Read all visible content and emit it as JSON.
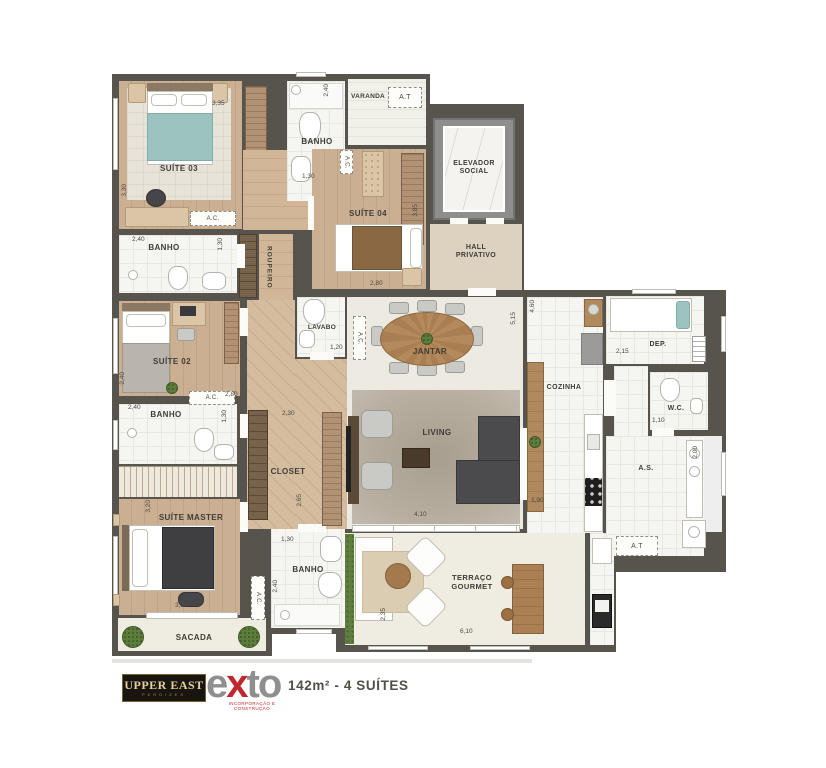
{
  "plan": {
    "shared": {
      "ac": "A.C.",
      "at": "A.T"
    },
    "rooms": {
      "suite03": {
        "label": "SUÍTE 03",
        "dim_w": "3,35",
        "dim_h": "3,30"
      },
      "banho04": {
        "label": "BANHO",
        "dim_h": "2,40",
        "dim_w": "1,30"
      },
      "varanda": {
        "label": "VARANDA"
      },
      "suite04": {
        "label": "SUÍTE 04",
        "dim_w": "2,80",
        "dim_h": "3,85"
      },
      "elevador": {
        "line1": "ELEVADOR",
        "line2": "SOCIAL"
      },
      "hall": {
        "line1": "HALL",
        "line2": "PRIVATIVO"
      },
      "roupeiro": {
        "label": "ROUPEIRO"
      },
      "banho03": {
        "label": "BANHO",
        "dim_w": "2,40",
        "dim_h": "1,30"
      },
      "suite02": {
        "label": "SUÍTE 02",
        "dim_w": "2,80",
        "dim_h": "2,40"
      },
      "banho02": {
        "label": "BANHO",
        "dim_w": "2,40",
        "dim_h": "1,30"
      },
      "lavabo": {
        "label": "LAVABO",
        "dim_w": "1,20"
      },
      "jantar": {
        "label": "JANTAR",
        "dim_h": "5,15"
      },
      "cozinha": {
        "label": "COZINHA",
        "dim_h": "4,60",
        "dim_w": "1,90"
      },
      "dep": {
        "label": "DEP.",
        "dim_w": "2,15"
      },
      "wc": {
        "label": "W.C.",
        "dim_w": "1,10"
      },
      "as": {
        "label": "A.S.",
        "dim_h": "2,00"
      },
      "corredor": {
        "dim_w": "2,30"
      },
      "closet": {
        "label": "CLOSET",
        "dim_h": "2,65"
      },
      "master": {
        "label": "SUÍTE MASTER",
        "dim_h": "3,20",
        "dim_w": "3,30"
      },
      "banhoMaster": {
        "label": "BANHO",
        "dim_w": "1,30",
        "dim_h": "2,40"
      },
      "sacada": {
        "label": "SACADA"
      },
      "living": {
        "label": "LIVING",
        "dim_w": "4,10"
      },
      "terraco": {
        "line1": "TERRAÇO",
        "line2": "GOURMET",
        "dim_w": "6,10",
        "dim_h": "2,35"
      }
    }
  },
  "footer": {
    "brand_primary": "UPPER EAST",
    "brand_primary_sub": "PERDIZES",
    "brand_secondary_part1": "e",
    "brand_secondary_part2": "x",
    "brand_secondary_part3": "to",
    "brand_secondary_sub": "INCORPORAÇÃO E CONSTRUÇÃO",
    "caption": "142m² - 4 SUÍTES"
  }
}
